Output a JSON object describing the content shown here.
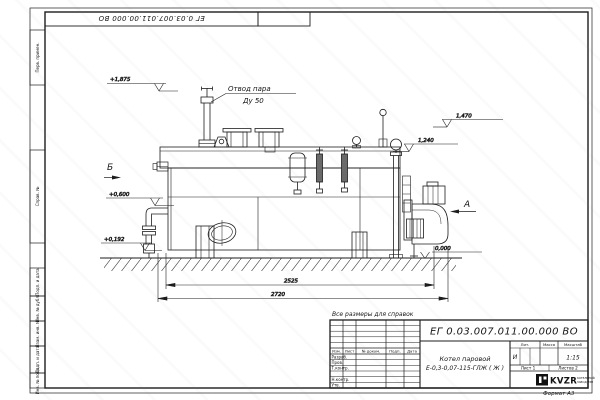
{
  "frame": {
    "stamp_top": "ЕГ 0.03.007.011.00.000  ВО",
    "format_label": "Формат А3",
    "margin_labels": [
      "Перв. примен.",
      "Справ. №",
      "Подп. и дата",
      "Инв. № дубл.",
      "Взам. инв. №",
      "Подп. и дата",
      "Инв. № подл."
    ]
  },
  "drawing": {
    "note": "Все размеры для справок",
    "labels": {
      "steam_line1": "Отвод пара",
      "steam_line2": "Ду 50",
      "view_a": "А",
      "view_b": "Б"
    },
    "elevations": {
      "e1": "+1,875",
      "e2": "1,470",
      "e3": "1,240",
      "e4": "+0,600",
      "e5": "+0,192",
      "e6": "0,000"
    },
    "dimensions": {
      "top": "2525",
      "bottom": "2720"
    }
  },
  "title_block": {
    "designation": "ЕГ 0.03.007.011.00.000  ВО",
    "product_line1": "Котел паровой",
    "product_line2": "Е-0,3-0,07-115-ГЛЖ ( Ж )",
    "col_izm": "Изм.",
    "col_list": "Лист",
    "col_doc": "№ докум.",
    "col_podp": "Подп.",
    "col_data": "Дата",
    "row_razrab": "Разраб.",
    "row_prov": "Пров.",
    "row_tkontr": "Т.контр.",
    "row_nkontr": "Н.контр.",
    "row_utv": "Утв.",
    "lit_header": "Лит.",
    "mass_header": "Масса",
    "scale_header": "Масштаб",
    "lit_value": "И",
    "scale_value": "1:15",
    "sheet": "Лист 1",
    "sheets": "Листов 2",
    "logo_text": "KVZR",
    "logo_sub1": "КОТЕЛЬНЫЙ",
    "logo_sub2": "ЗАВОД РЭП"
  }
}
